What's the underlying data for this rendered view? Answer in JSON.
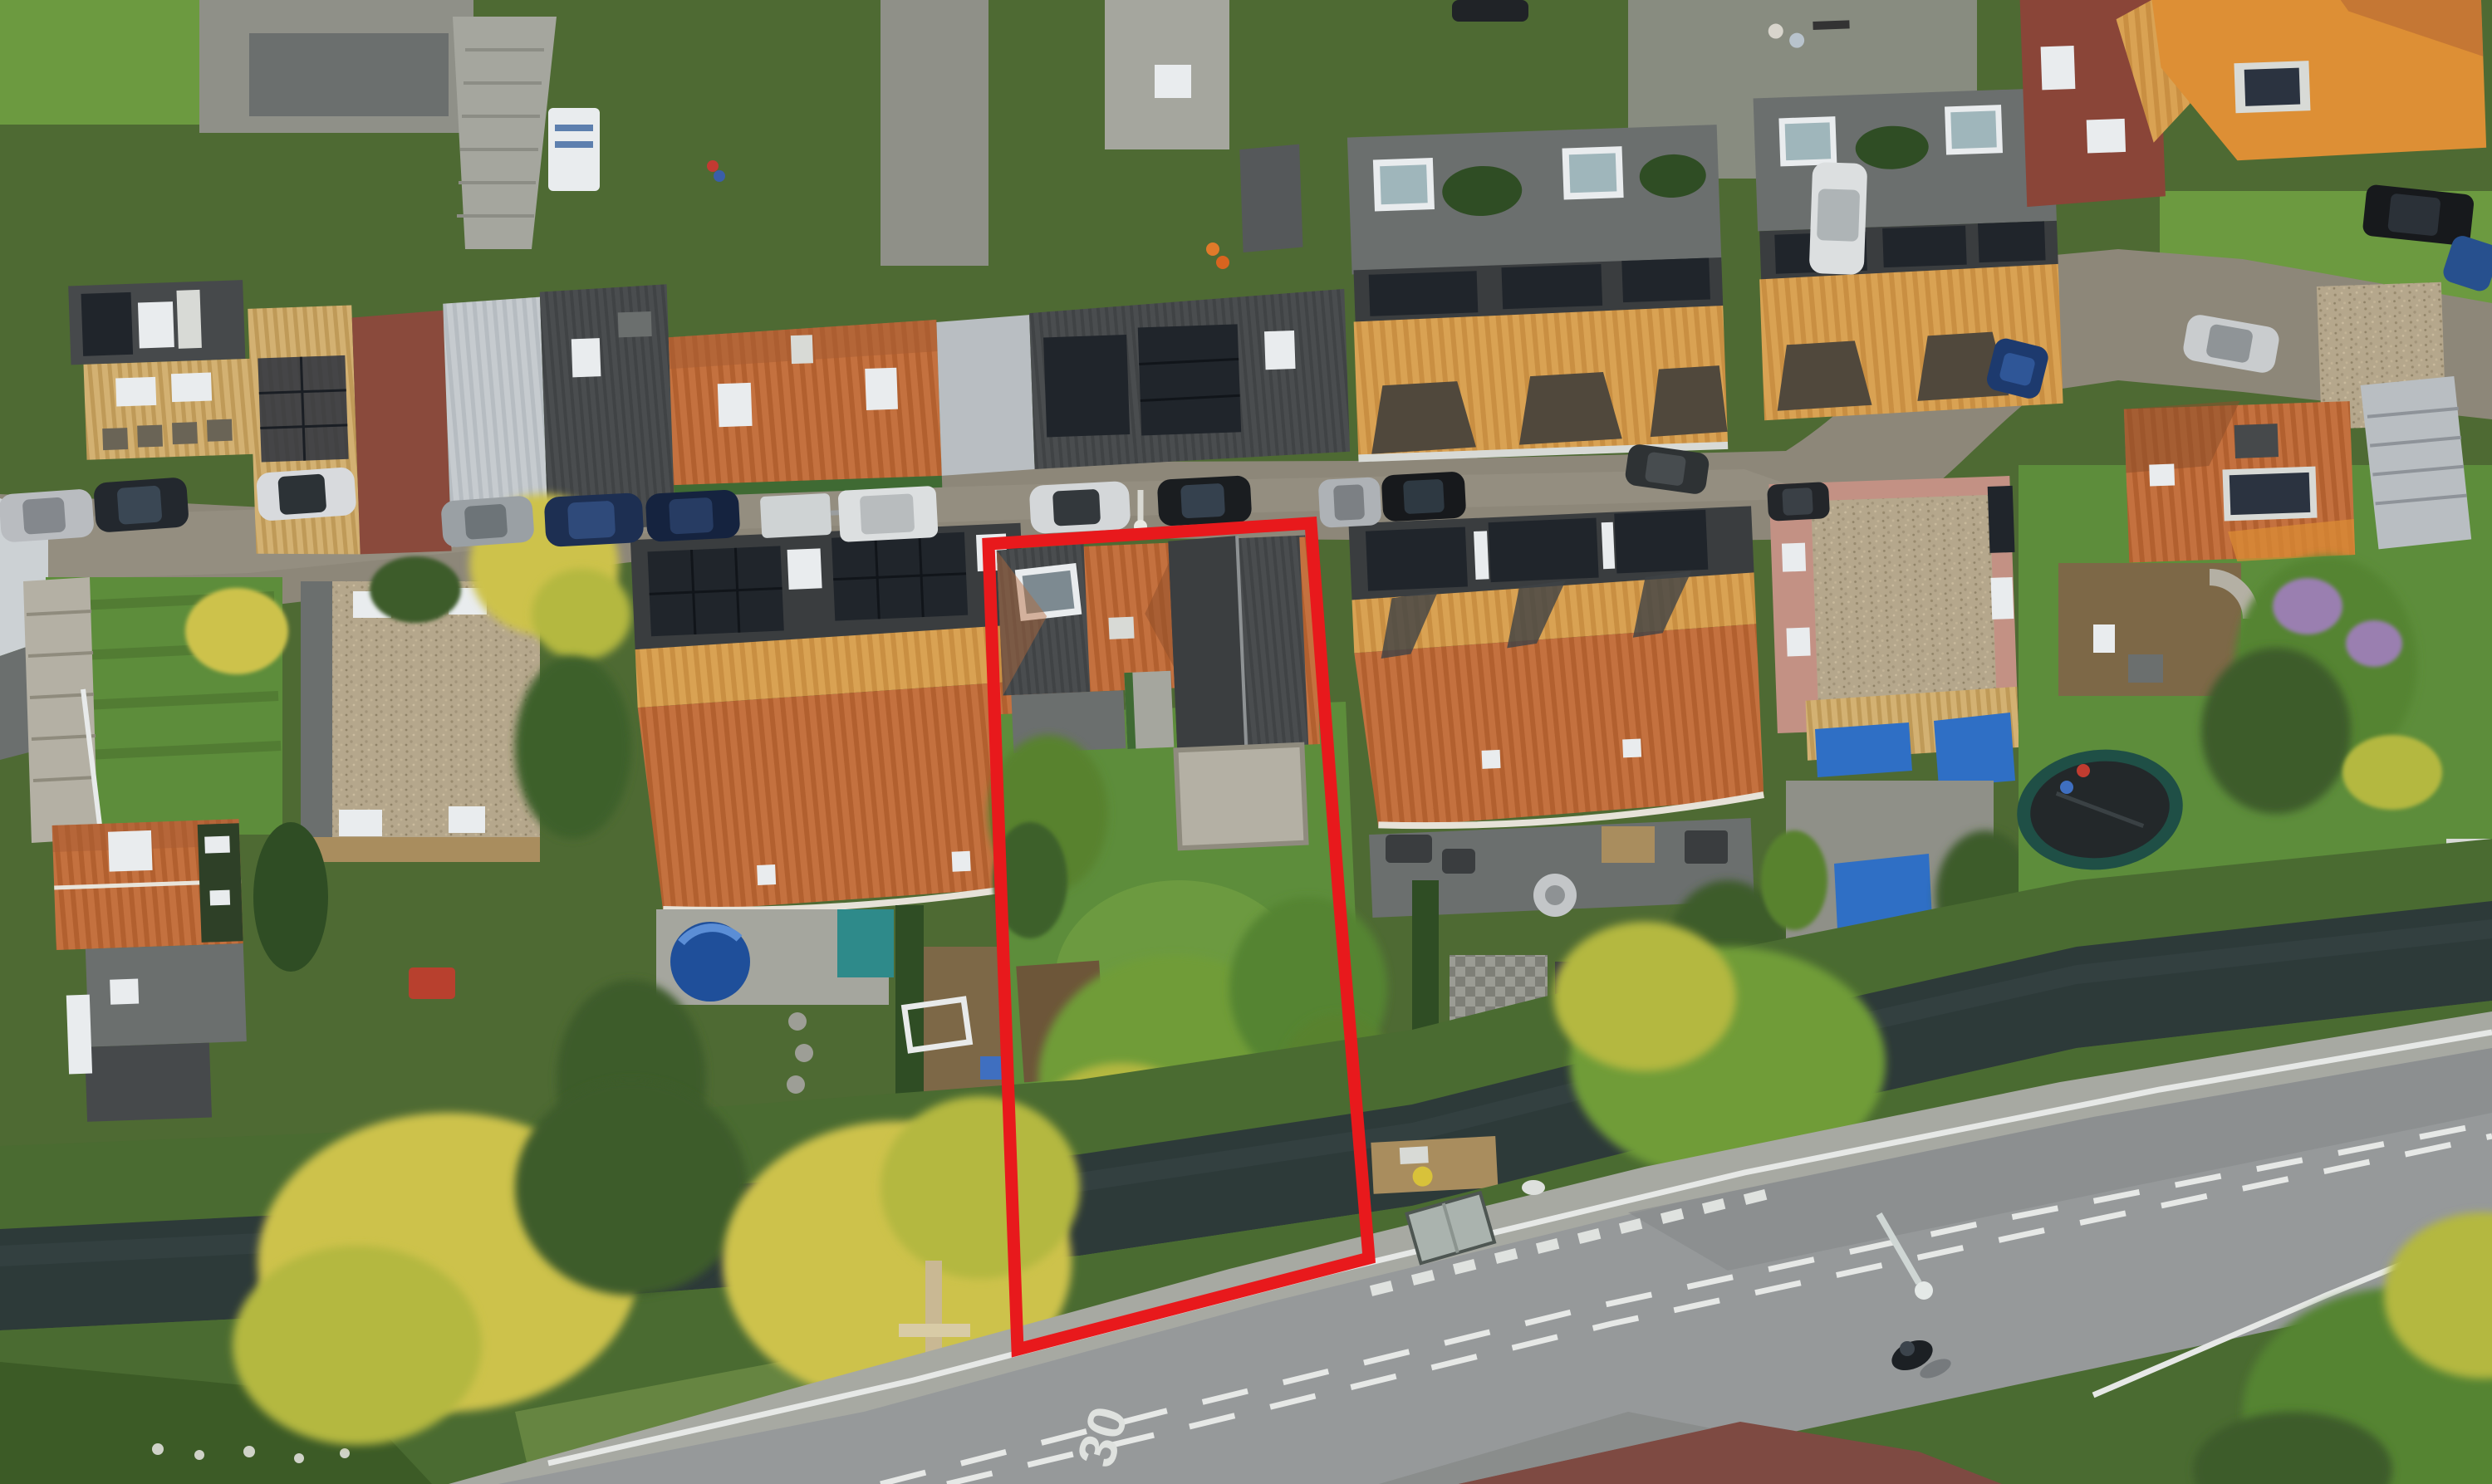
{
  "scene": {
    "type": "aerial-drone-photograph",
    "description": "Top-down drone photo of a Dutch residential street with terraced and detached houses, back gardens, a canal and a main road; one garden plot is highlighted with a red boundary outline.",
    "time_of_day": "low evening sun with long shadows"
  },
  "road": {
    "speed_marking": "30"
  },
  "annotation": {
    "label": "property-boundary-outline",
    "shape": "polygon",
    "color": "#e8191c"
  },
  "colors": {
    "plot-outline": "#e8191c",
    "canal-water": "#2d3a39",
    "road-asphalt": "#96999a",
    "street-asphalt": "#8d8779",
    "lawn-green": "#5d8d3b",
    "garden-green": "#4e6a33",
    "bank-green": "#4a6b31",
    "roof-orange": "#c4703f",
    "roof-dark": "#46494b",
    "roof-tan": "#cfa867",
    "solar-panel": "#20252b",
    "tarp-blue": "#2f6fc5",
    "sunlit-tree": "#cdc24c"
  },
  "objects": {
    "highlighted_plot": [
      "hip-roof-house",
      "dark-barn-roof",
      "concrete-patio",
      "lawn",
      "garden-trees"
    ],
    "vehicles": [
      "parked-cars-along-street",
      "white-van",
      "small-trailer",
      "white-car-on-driveway",
      "cyclist-on-main-road"
    ],
    "landscape": [
      "canal",
      "grass-bank",
      "wooden-mooring-pole",
      "sunlit-trees",
      "blue-tarps",
      "round-pool",
      "trampoline",
      "street-lamp",
      "utility-box"
    ]
  }
}
